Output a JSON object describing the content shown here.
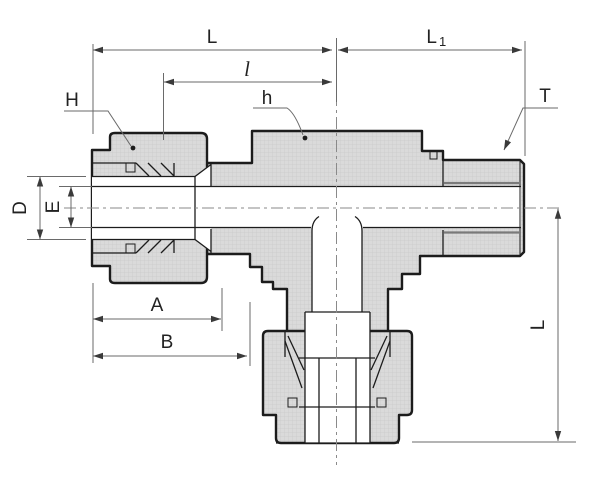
{
  "drawing": {
    "type": "technical-drawing",
    "subject": "Tube fitting (male run tee) cross-section with dimension callouts",
    "dimension_labels": {
      "top_span": "L",
      "top_right_span_main": "L",
      "top_right_span_sub": "1",
      "inner_span": "l",
      "nut_hex": "H",
      "body_hex": "h",
      "thread": "T",
      "tube_od": "D",
      "bore": "E",
      "nut_length": "A",
      "assembly_length": "B",
      "vertical_span": "L"
    },
    "colors": {
      "outline": "#1c1c1c",
      "metal_fill": "#dadada",
      "hatch_line": "#c9c9c9",
      "thread_root": "#7a7a7a",
      "dimension_line": "#6a6a6a",
      "centerline": "#8a8a8a",
      "arrow": "#3a3a3a",
      "label_text": "#222222",
      "background": "#ffffff"
    }
  }
}
